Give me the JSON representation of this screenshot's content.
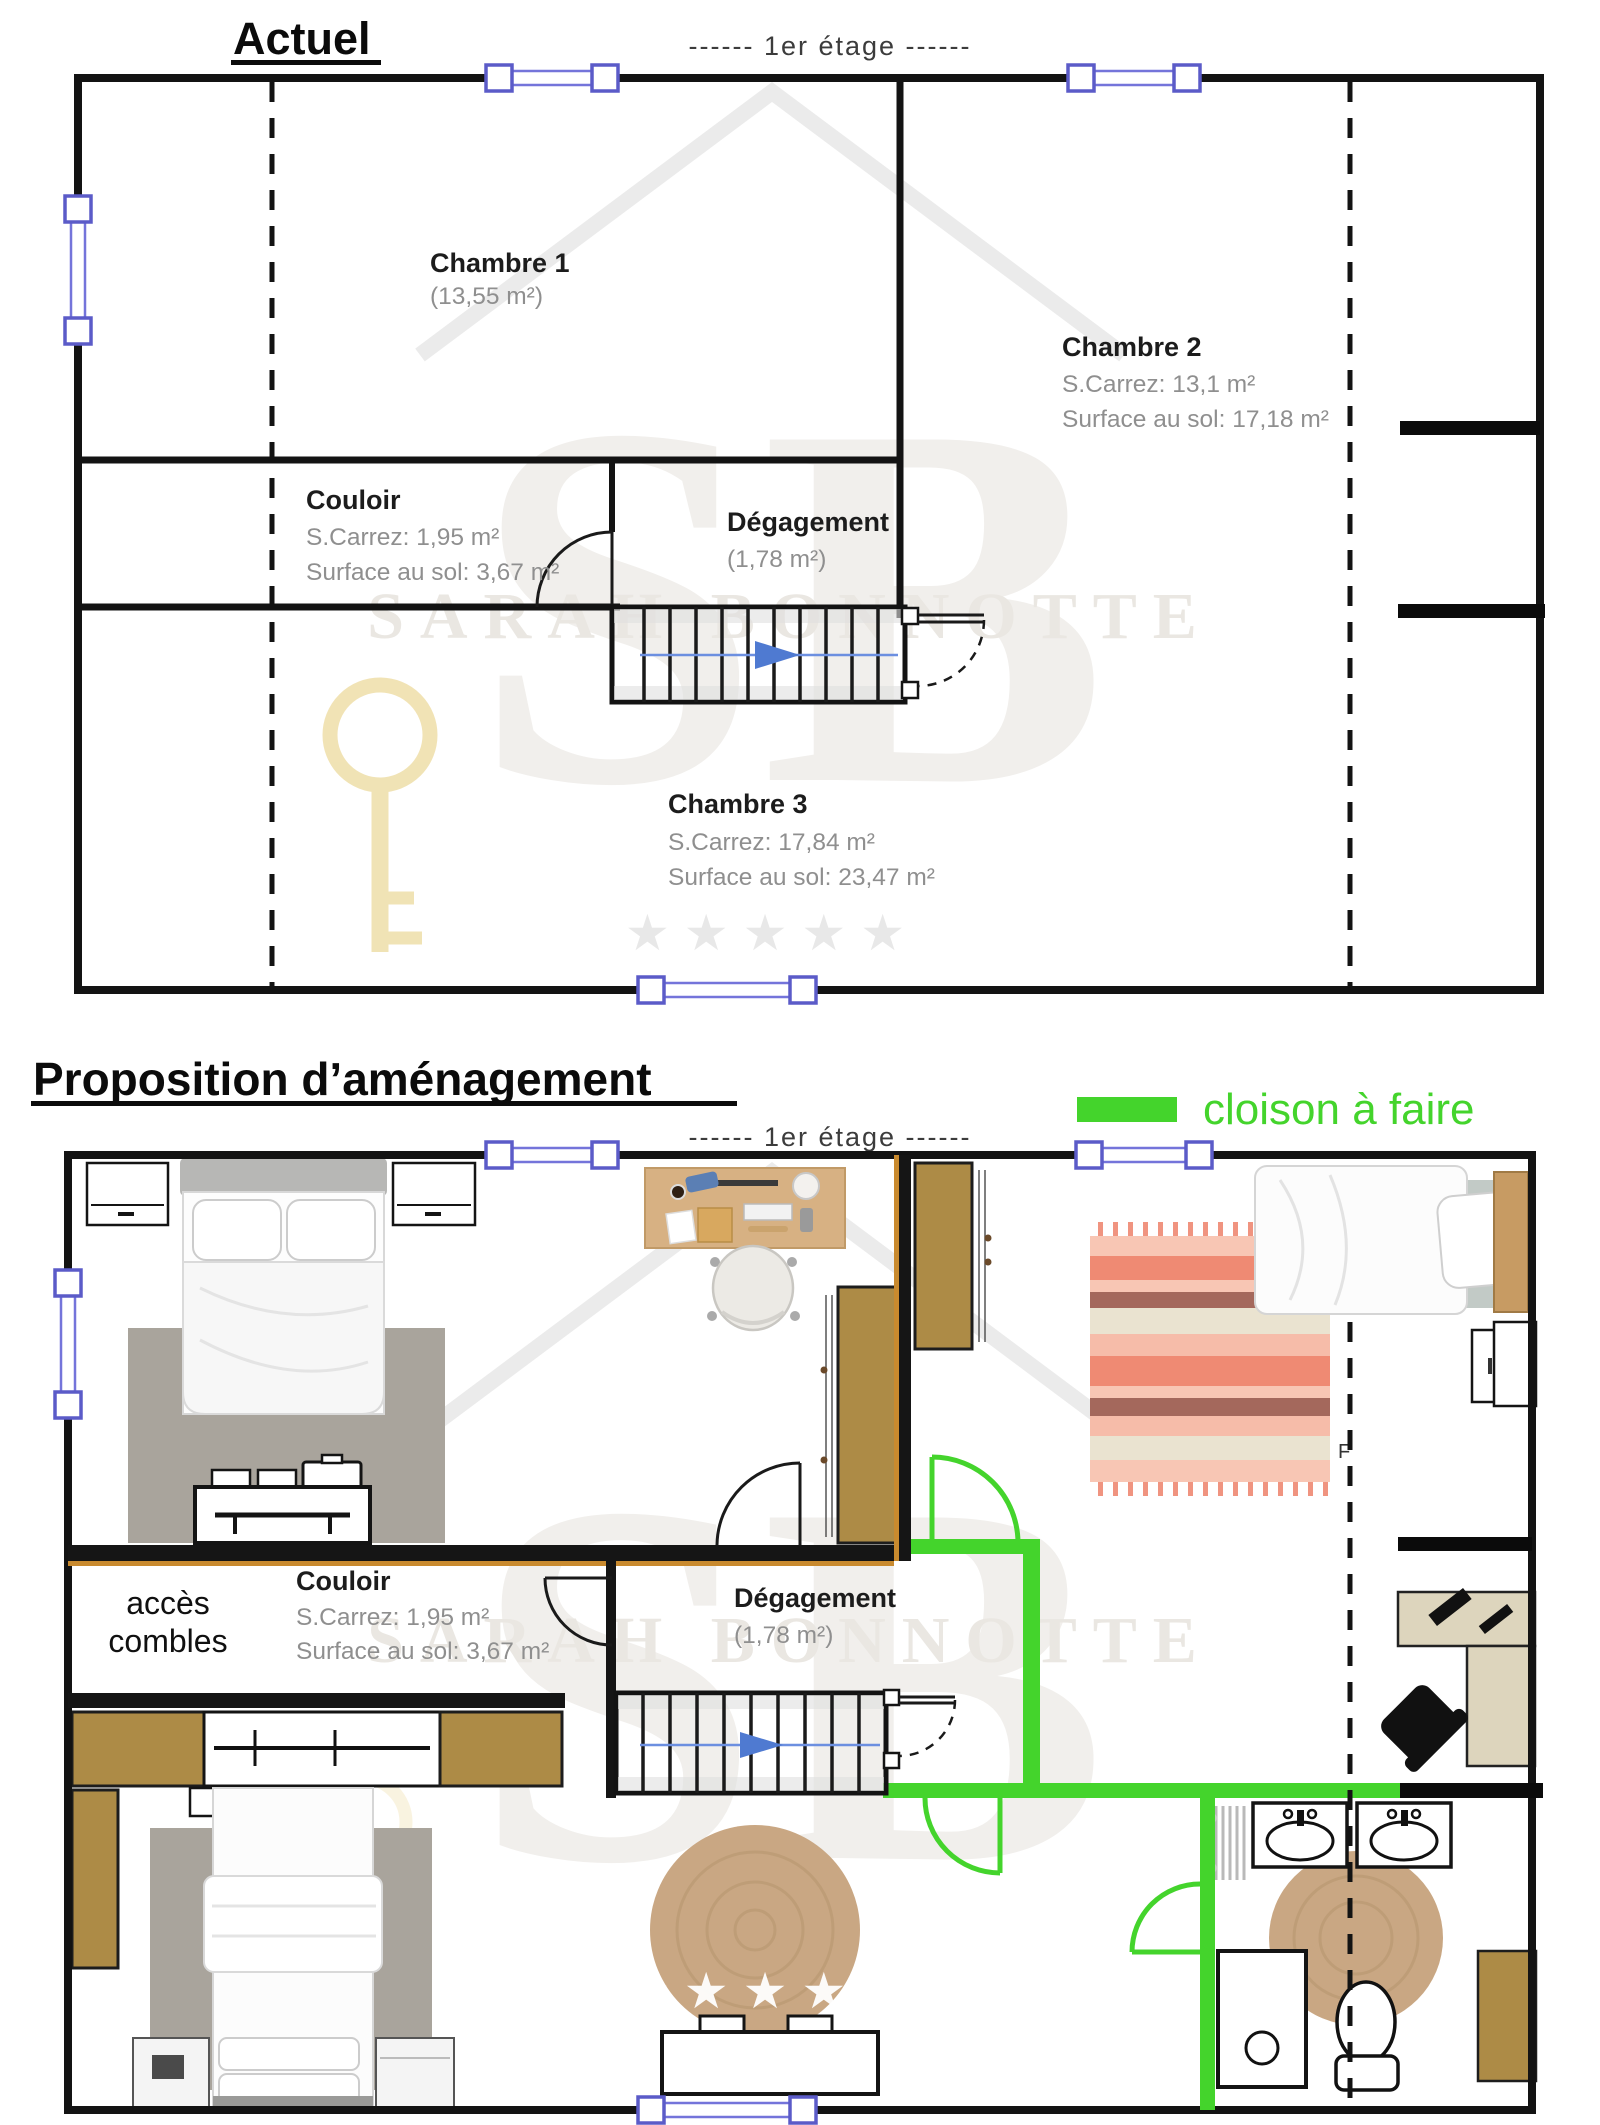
{
  "watermark": {
    "initials": "SB",
    "name": "SARAH BONNOTTE",
    "stars": "★★★★★"
  },
  "actuel": {
    "title": "Actuel",
    "floor_label": "------  1er étage  ------",
    "rooms": {
      "chambre1": {
        "name": "Chambre 1",
        "area": "(13,55 m²)"
      },
      "chambre2": {
        "name": "Chambre 2",
        "carrez": "S.Carrez: 13,1 m²",
        "sol": "Surface au sol: 17,18 m²"
      },
      "couloir": {
        "name": "Couloir",
        "carrez": "S.Carrez: 1,95 m²",
        "sol": "Surface au sol: 3,67 m²"
      },
      "degagement": {
        "name": "Dégagement",
        "area": "(1,78 m²)"
      },
      "chambre3": {
        "name": "Chambre 3",
        "carrez": "S.Carrez: 17,84 m²",
        "sol": "Surface au sol: 23,47 m²"
      }
    }
  },
  "proposition": {
    "title": "Proposition d’aménagement",
    "floor_label": "------  1er étage  ------",
    "legend": {
      "label": "cloison à faire"
    },
    "labels": {
      "acces_line1": "accès",
      "acces_line2": "combles",
      "couloir": {
        "name": "Couloir",
        "carrez": "S.Carrez: 1,95 m²",
        "sol": "Surface au sol: 3,67 m²"
      },
      "degagement": {
        "name": "Dégagement",
        "area": "(1,78 m²)"
      },
      "remnant": "F"
    }
  },
  "colors": {
    "partition_green": "#44d42c",
    "window_purple": "#5b5bc8",
    "furniture_brown": "#ad8b46",
    "accent_orange": "#c98a2e",
    "desk_wood": "#d7b183",
    "rug_gray": "#a9a49c",
    "rug_jute": "#c9a783",
    "rug_salmon": "#ef8a73",
    "watermark_gold": "#efe0ad"
  }
}
